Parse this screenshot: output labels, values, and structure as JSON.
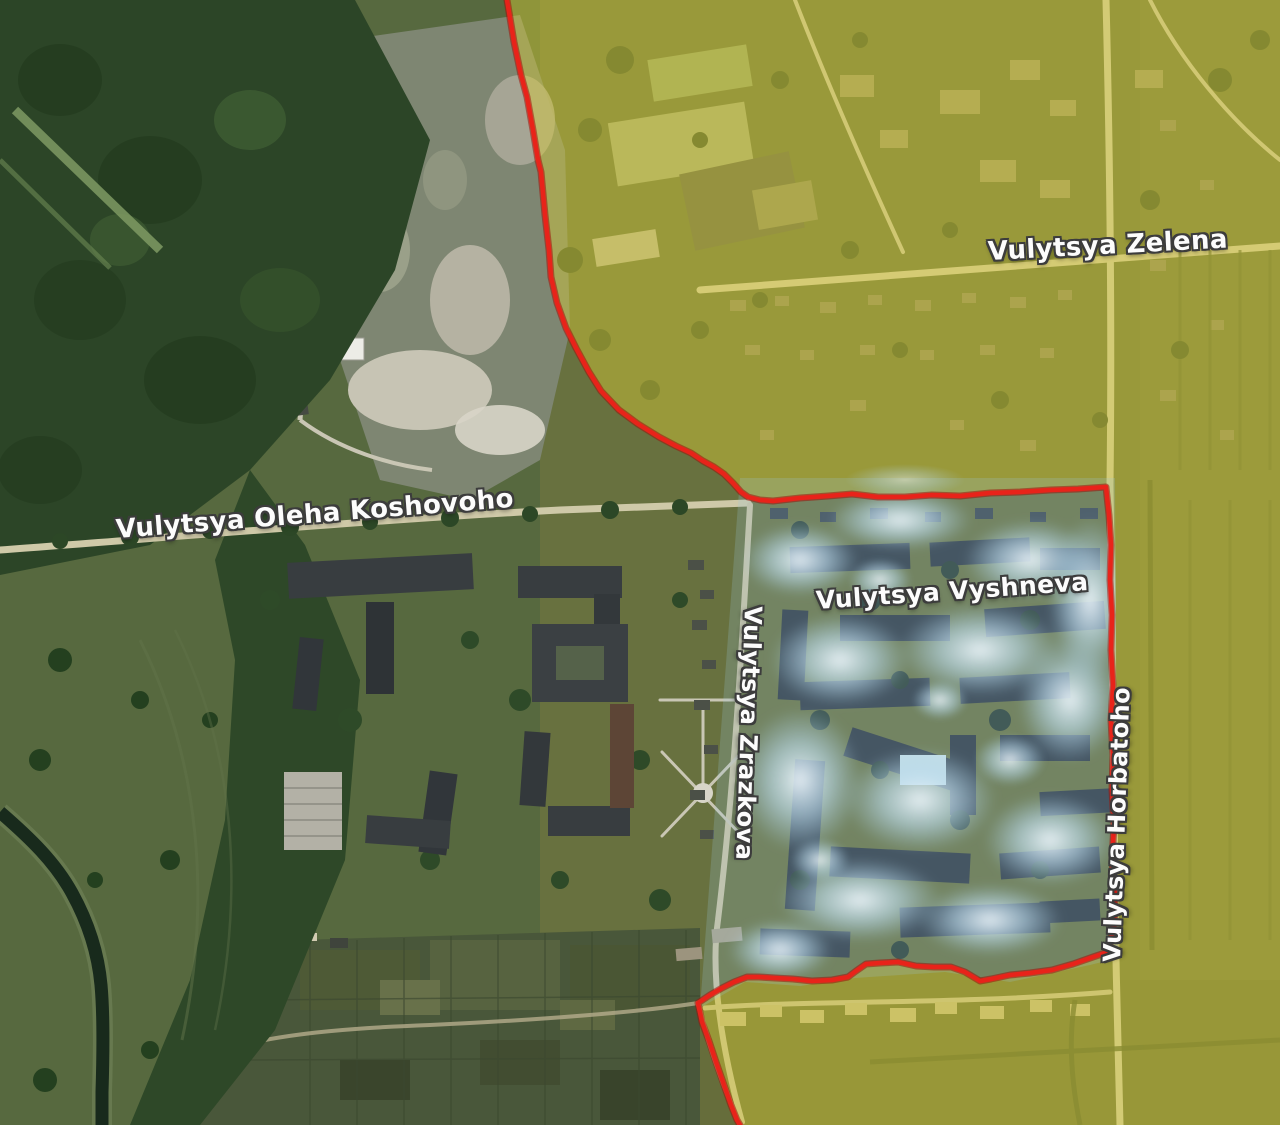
{
  "map": {
    "description": "Annotated satellite map with a red frontline boundary, yellow-tinted controlled zone and blue smoke-covered contested block",
    "street_labels": {
      "zelena": "Vulytsya Zelena",
      "koshovoho": "Vulytsya Oleha Koshovoho",
      "vyshneva": "Vulytsya Vyshneva",
      "zrazkova": "Vulytsya Zrazkova",
      "horbatoho": "Vulytsya Horbatoho"
    },
    "colors": {
      "frontline": "#e8231a",
      "frontline_casing": "#9e130a",
      "yellow_zone": "#d8cc34",
      "blue_zone": "#9cc9e0"
    }
  }
}
